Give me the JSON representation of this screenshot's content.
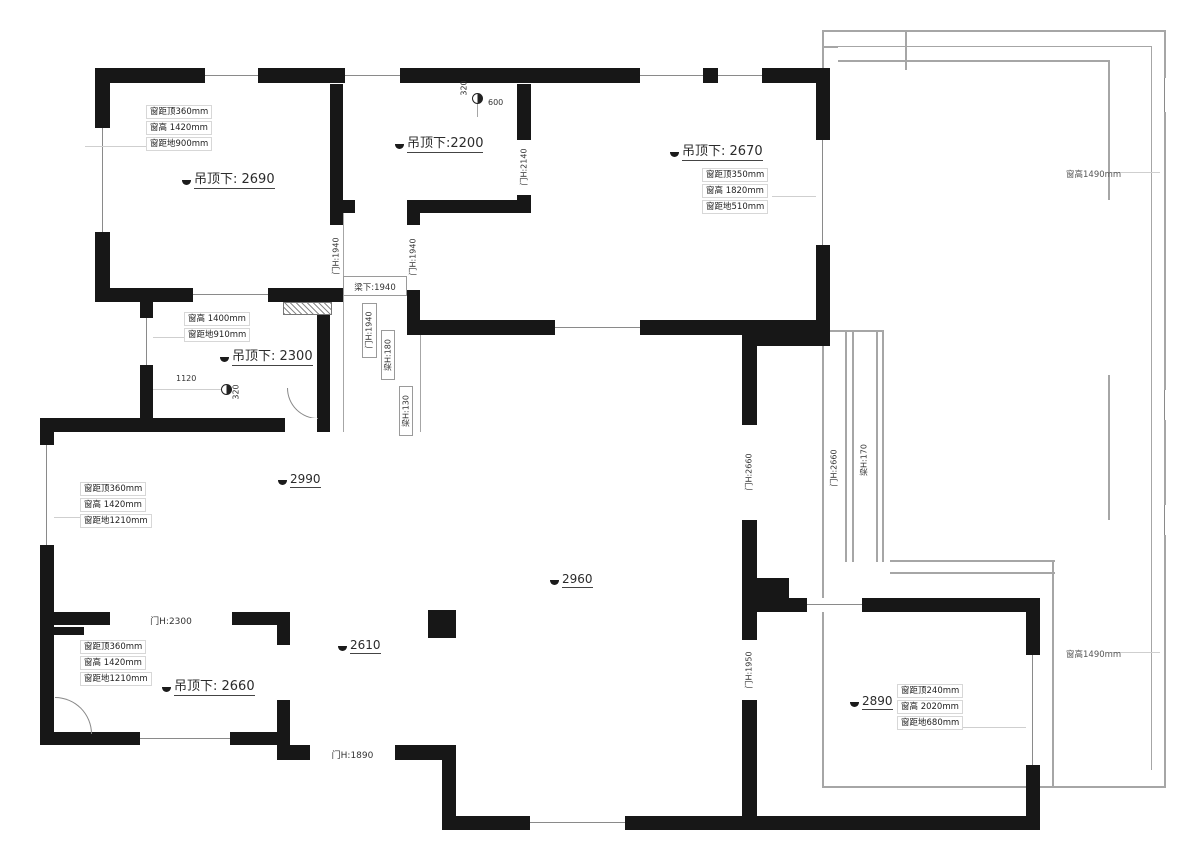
{
  "ceilings": {
    "topleft": "吊顶下: 2690",
    "topmid": "吊顶下:2200",
    "topright": "吊顶下: 2670",
    "midleft": "吊顶下: 2300",
    "bottomleft": "吊顶下: 2660"
  },
  "heights": {
    "living1": "2990",
    "living2": "2960",
    "living3": "2610",
    "bottomright": "2890"
  },
  "doors": {
    "corridor_left": "门H:1940",
    "corridor_mid": "门H:1940",
    "corridor_right": "门H:1940",
    "topmid": "门H:2140",
    "living_balcony": "门H:2660",
    "balcony_band": "门H:2660",
    "bottomright_entry": "门H:1950",
    "bottomleft_top": "门H:2300",
    "living_bottom": "门H:1890"
  },
  "beams": {
    "corridor": "梁下:1940",
    "h180": "梁H:180",
    "h130": "梁H:130",
    "h170": "梁H:170"
  },
  "dims": {
    "spot1_h": "600",
    "spot1_v": "320",
    "spot2_h": "1120",
    "spot2_v": "320"
  },
  "window_heights": {
    "right_top": "窗高1490mm",
    "right_bottom": "窗高1490mm"
  },
  "notes": {
    "topleft": [
      "窗距顶360mm",
      "窗高 1420mm",
      "窗距地900mm"
    ],
    "topright": [
      "窗距顶350mm",
      "窗高 1820mm",
      "窗距地510mm"
    ],
    "midleft": [
      "窗高 1400mm",
      "窗距地910mm"
    ],
    "living_left": [
      "窗距顶360mm",
      "窗高 1420mm",
      "窗距地1210mm"
    ],
    "bottomleft": [
      "窗距顶360mm",
      "窗高 1420mm",
      "窗距地1210mm"
    ],
    "bottomright": [
      "窗距顶240mm",
      "窗高 2020mm",
      "窗距地680mm"
    ]
  }
}
